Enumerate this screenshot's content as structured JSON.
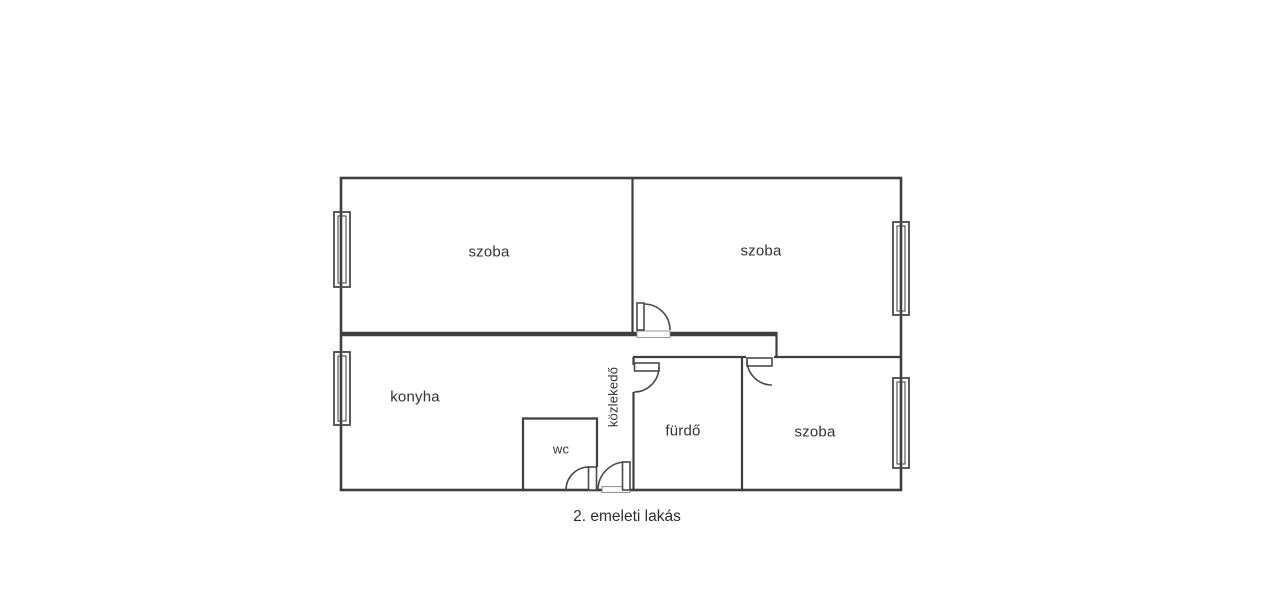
{
  "floorplan": {
    "caption": "2. emeleti lakás",
    "rooms": {
      "room_top_left": "szoba",
      "room_top_right": "szoba",
      "kitchen": "konyha",
      "hallway": "közlekedő",
      "bathroom": "fürdő",
      "wc": "wc",
      "room_bottom_right": "szoba"
    },
    "colors": {
      "wall": "#3f3f3f",
      "text": "#333333",
      "background": "#ffffff"
    }
  }
}
